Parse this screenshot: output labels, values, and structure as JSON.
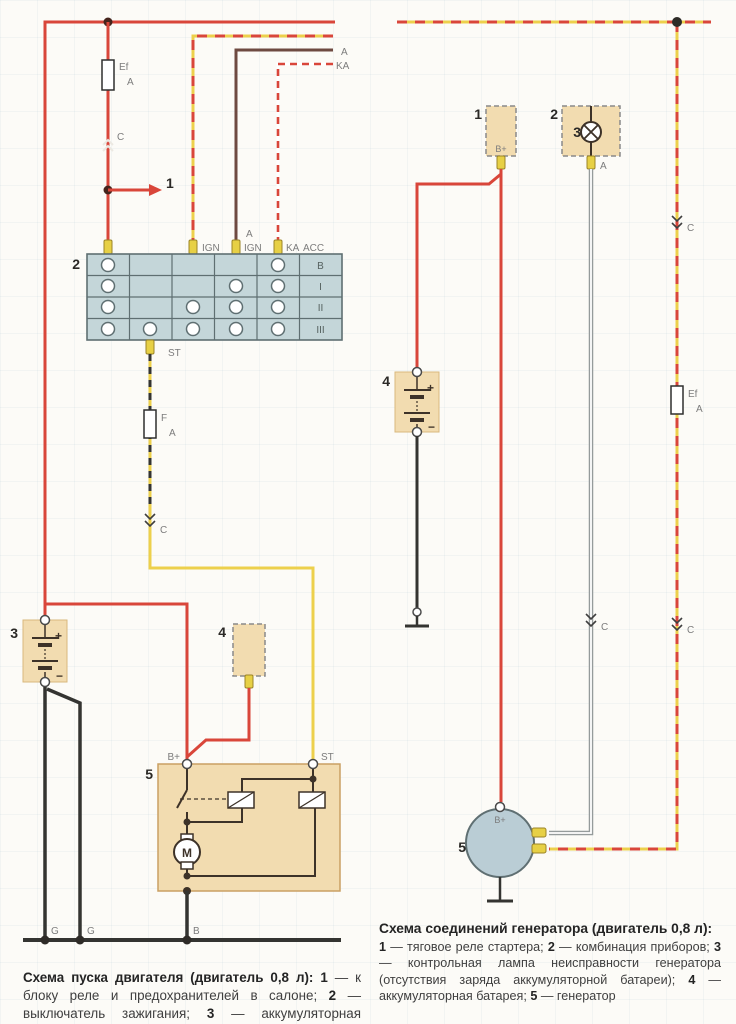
{
  "colors": {
    "red": "#d9463a",
    "yellow": "#edd04c",
    "brown": "#6e4a41",
    "black": "#343431",
    "gray": "#959b9b",
    "inner": "#3d3228",
    "tan": "#f2dcb0",
    "blue": "#c4d6d9",
    "frame": "#5f6f72",
    "pin": "#e7d045",
    "label": "#7c7c7c",
    "num": "#2b2926"
  },
  "left": {
    "fuse_top_name": "Ef",
    "fuse_top_amp": "A",
    "conn_c": "C",
    "branch_num": "1",
    "wire_a": "A",
    "wire_ka": "KA",
    "pin_ign": "IGN",
    "pin_a": "A",
    "pin_ign2": "IGN",
    "pin_ka": "KA",
    "pin_acc": "ACC",
    "switch_num": "2",
    "rows": [
      "B",
      "I",
      "II",
      "III"
    ],
    "pin_st": "ST",
    "fuse_mid_name": "F",
    "fuse_mid_amp": "A",
    "conn_c2": "C",
    "bat_num": "3",
    "bat_plus": "+",
    "bat_minus": "−",
    "gen_num": "4",
    "starter_num": "5",
    "starter_bplus": "B+",
    "starter_st": "ST",
    "motor_m": "M",
    "gnd_g1": "G",
    "gnd_g2": "G",
    "gnd_b": "B",
    "caption": [
      "Схема пуска двигателя (двигатель 0,8 л): ",
      "1",
      " — к блоку реле и предохранителей в салоне; ",
      "2",
      " — выключатель зажигания; ",
      "3",
      " — аккумуляторная батарея; ",
      "4",
      " — генератор; ",
      "5",
      " — стартер"
    ]
  },
  "right": {
    "relay_num": "1",
    "relay_bplus": "B+",
    "cluster_num": "2",
    "lamp_num": "3",
    "pin_a": "A",
    "conn_c1": "C",
    "conn_c2": "C",
    "conn_c3": "C",
    "fuse_name": "Ef",
    "fuse_amp": "A",
    "bat_num": "4",
    "bat_plus": "+",
    "bat_minus": "−",
    "gen_num": "5",
    "gen_bplus": "B+",
    "caption_title": "Схема соединений генератора (двигатель 0,8 л):",
    "caption": [
      "1",
      " — тяговое реле стартера; ",
      "2",
      " — комбинация приборов; ",
      "3",
      " — контрольная лампа неисправности генератора (отсутствия заряда аккумуляторной батареи); ",
      "4",
      " — аккумуляторная батарея; ",
      "5",
      " — генератор"
    ]
  }
}
